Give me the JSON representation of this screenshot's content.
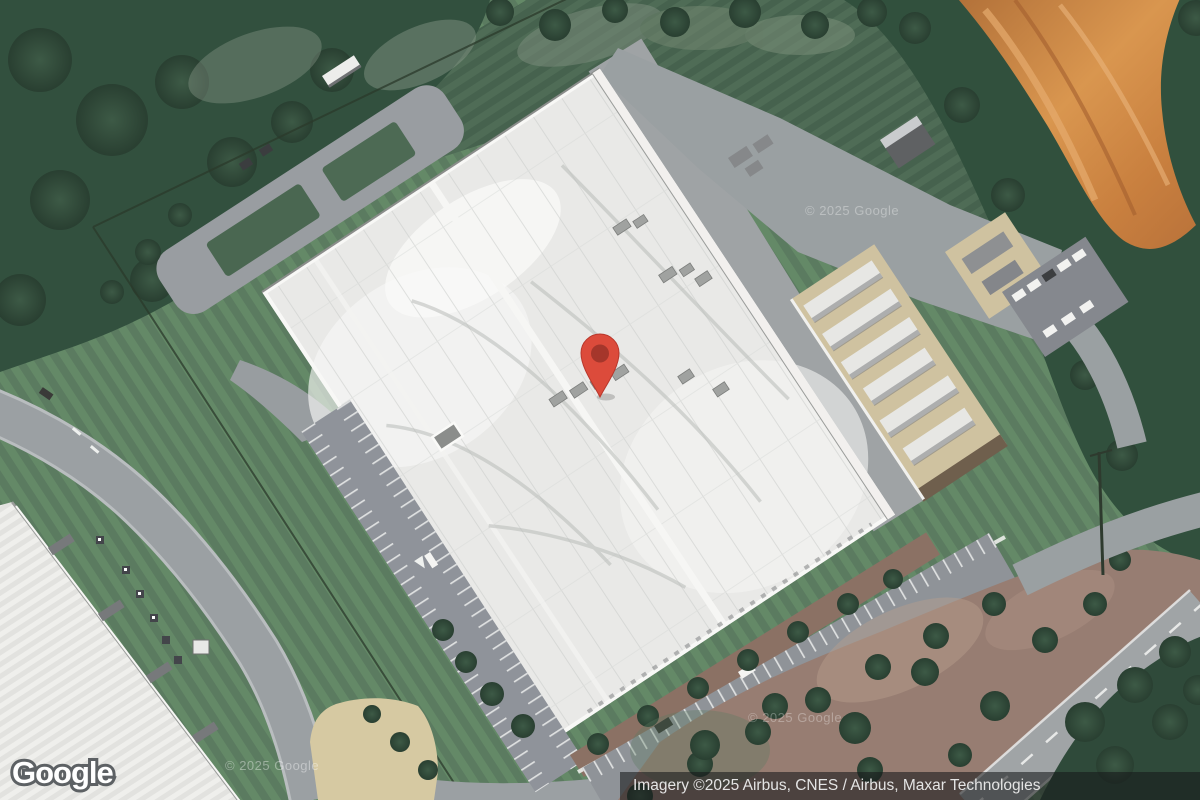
{
  "map": {
    "provider_logo": "Google",
    "attribution": "Imagery ©2025 Airbus, CNES / Airbus, Maxar Technologies",
    "watermarks": [
      "© 2025 Google",
      "© 2025 Google",
      "© 2025 Google"
    ],
    "marker": {
      "x": 600,
      "y": 400,
      "color": "#DC4B3B",
      "inner_color": "#A5362B"
    },
    "colors": {
      "grass_light": "#628767",
      "grass_dark": "#46624e",
      "forest": "#32503e",
      "roof_white": "#e9e9e7",
      "road_gray": "#9ba0a3",
      "dirt_orange": "#c9803f",
      "equipment_tan": "#cfc2a0",
      "mulch_brown": "#977d72",
      "attribution_bg": "rgba(22,24,26,0.58)",
      "attribution_text": "#e4e4e4"
    }
  }
}
